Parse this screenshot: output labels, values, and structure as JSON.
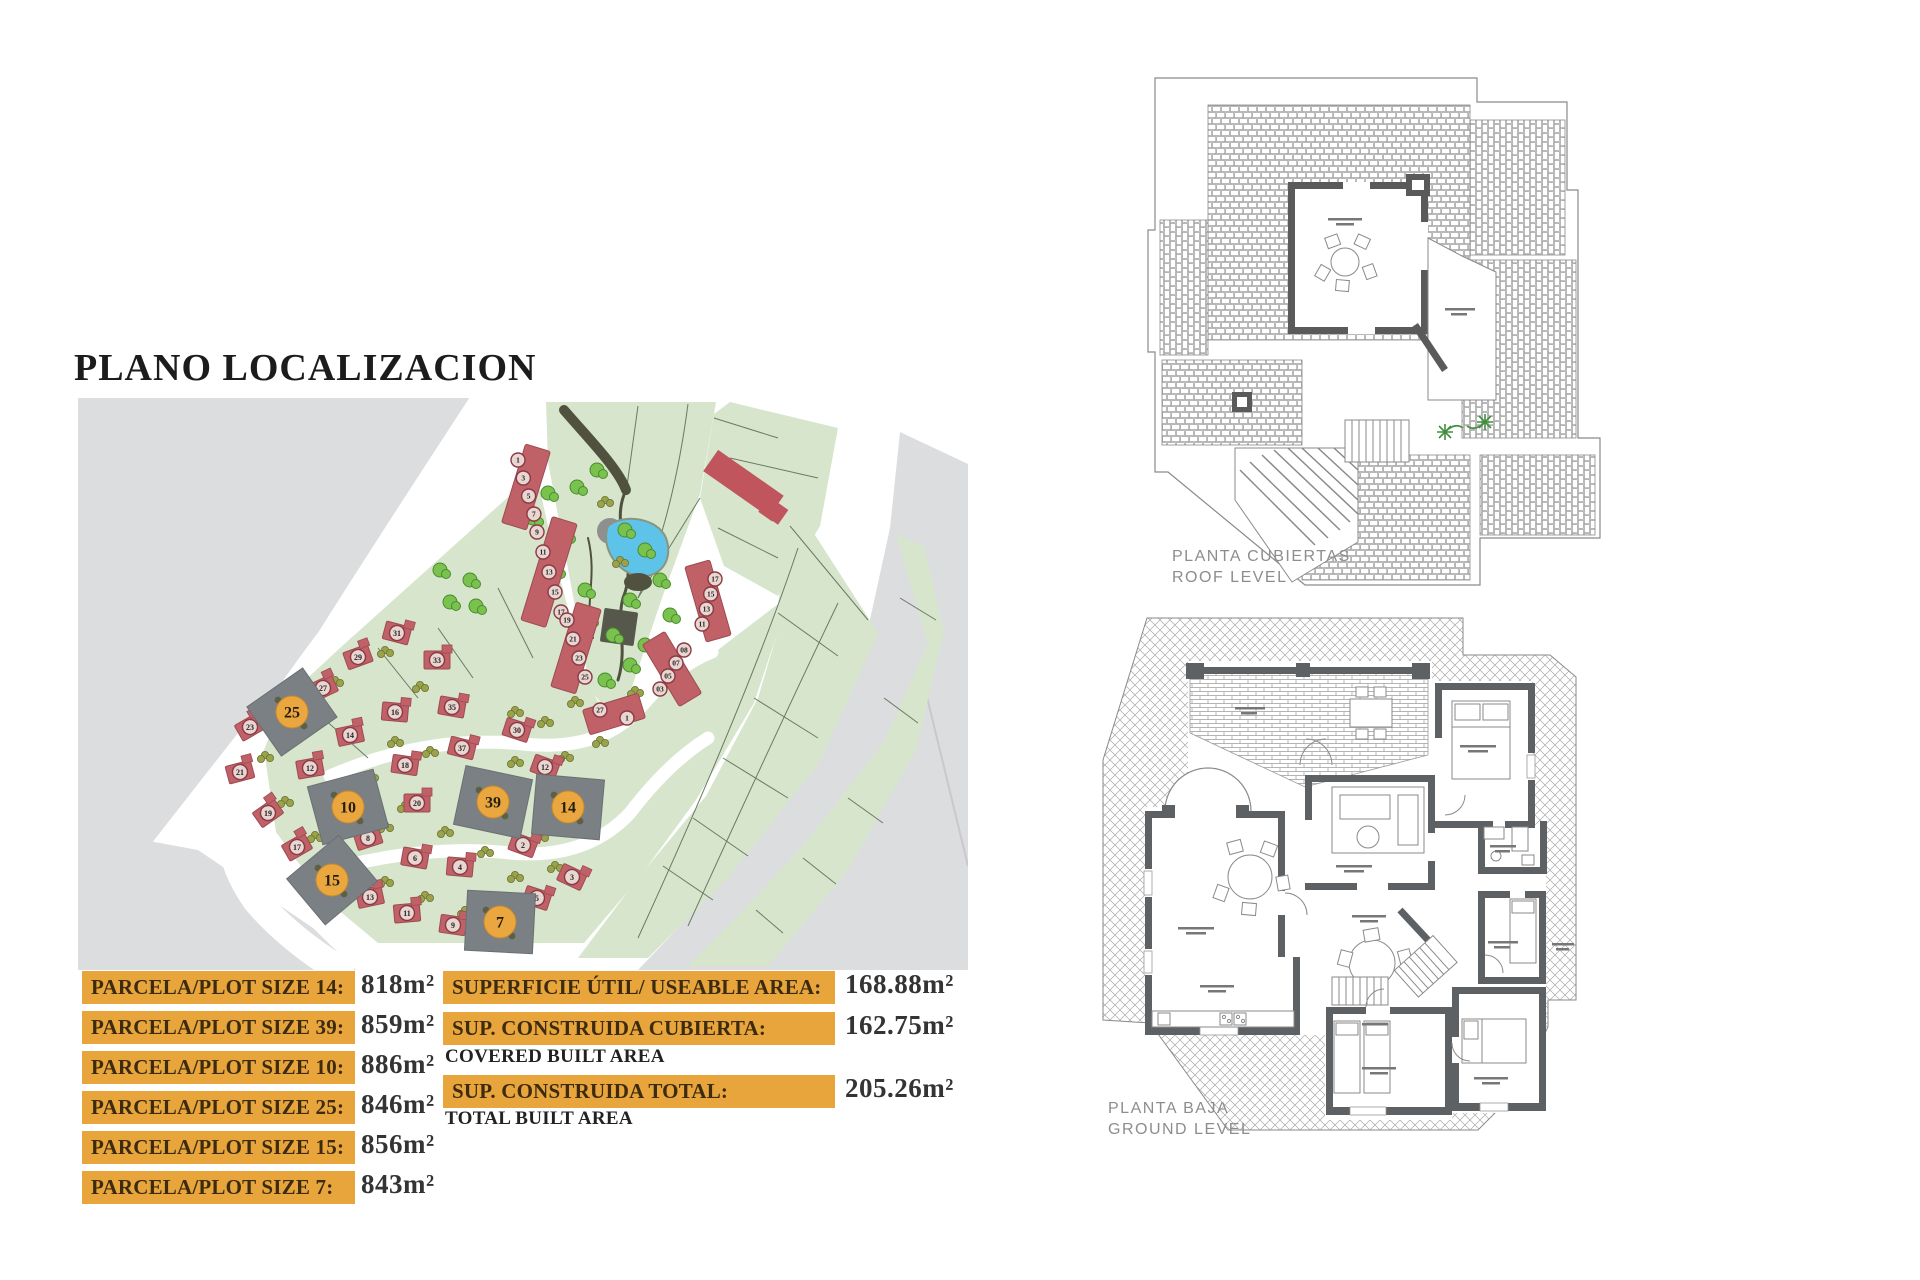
{
  "title": "PLANO LOCALIZACION",
  "tables": {
    "left": {
      "rows": [
        {
          "label": "PARCELA/PLOT SIZE 14:",
          "value": "818m²"
        },
        {
          "label": "PARCELA/PLOT SIZE 39:",
          "value": "859m²"
        },
        {
          "label": "PARCELA/PLOT SIZE 10:",
          "value": "886m²"
        },
        {
          "label": "PARCELA/PLOT SIZE 25:",
          "value": "846m²"
        },
        {
          "label": "PARCELA/PLOT SIZE 15:",
          "value": "856m²"
        },
        {
          "label": "PARCELA/PLOT SIZE 7:",
          "value": "843m²"
        }
      ]
    },
    "right": {
      "rows": [
        {
          "label": "SUPERFICIE ÚTIL/ USEABLE AREA:",
          "value": "168.88m²",
          "sub": ""
        },
        {
          "label": "SUP. CONSTRUIDA CUBIERTA:",
          "value": "162.75m²",
          "sub": "COVERED BUILT AREA"
        },
        {
          "label": "SUP. CONSTRUIDA TOTAL:",
          "value": "205.26m²",
          "sub": "TOTAL BUILT AREA"
        }
      ]
    }
  },
  "plans": {
    "roof": {
      "label_line1": "PLANTA CUBIERTAS",
      "label_line2": "ROOF LEVEL"
    },
    "ground": {
      "label_line1": "PLANTA BAJA",
      "label_line2": "GROUND LEVEL"
    }
  },
  "map": {
    "colors": {
      "green": "#d6e5cc",
      "gray": "#dcddde",
      "plot_gray": "#7b8084",
      "house_red": "#c06067",
      "house_stroke": "#9e4a52",
      "circle_orange": "#eaa73f",
      "tree_green": "#79c24d",
      "tree_olive": "#9aa24b",
      "pond_blue": "#5ec3e8",
      "path_dark": "#50523f",
      "ring_red": "#8a3a42"
    },
    "highlighted_plots": [
      {
        "n": "25",
        "x": 214,
        "y": 314,
        "rot": -35
      },
      {
        "n": "10",
        "x": 270,
        "y": 409,
        "rot": -15
      },
      {
        "n": "39",
        "x": 415,
        "y": 404,
        "rot": 12
      },
      {
        "n": "14",
        "x": 490,
        "y": 409,
        "rot": 5
      },
      {
        "n": "15",
        "x": 254,
        "y": 482,
        "rot": -40
      },
      {
        "n": "7",
        "x": 422,
        "y": 524,
        "rot": 3
      }
    ],
    "houses": [
      [
        "29",
        280,
        259,
        -20
      ],
      [
        "31",
        319,
        235,
        15
      ],
      [
        "33",
        359,
        262,
        0
      ],
      [
        "27",
        245,
        290,
        -25
      ],
      [
        "23",
        172,
        329,
        -30
      ],
      [
        "21",
        162,
        374,
        -15
      ],
      [
        "19",
        190,
        415,
        -35
      ],
      [
        "17",
        219,
        449,
        -30
      ],
      [
        "12",
        232,
        370,
        -10
      ],
      [
        "14",
        272,
        337,
        -12
      ],
      [
        "16",
        317,
        314,
        5
      ],
      [
        "18",
        327,
        367,
        8
      ],
      [
        "20",
        339,
        405,
        0
      ],
      [
        "8",
        290,
        440,
        -18
      ],
      [
        "6",
        337,
        460,
        10
      ],
      [
        "4",
        382,
        469,
        5
      ],
      [
        "2",
        445,
        447,
        20
      ],
      [
        "13",
        292,
        499,
        -12
      ],
      [
        "11",
        329,
        515,
        -5
      ],
      [
        "9",
        375,
        527,
        8
      ],
      [
        "5",
        459,
        500,
        18
      ],
      [
        "3",
        494,
        479,
        25
      ],
      [
        "35",
        374,
        309,
        10
      ],
      [
        "37",
        384,
        350,
        14
      ],
      [
        "30",
        439,
        332,
        18
      ],
      [
        "12",
        467,
        369,
        20
      ]
    ],
    "townhouse_rows": [
      {
        "cx": 448,
        "cy": 89,
        "len": 82,
        "rot": 17,
        "numbers": [
          "1",
          "3",
          "5",
          "7"
        ],
        "sx": 440,
        "sy": 62,
        "dx": 5.3,
        "dy": 18
      },
      {
        "cx": 471,
        "cy": 174,
        "len": 108,
        "rot": 17,
        "numbers": [
          "9",
          "11",
          "13",
          "15",
          "17"
        ],
        "sx": 459,
        "sy": 134,
        "dx": 6,
        "dy": 20
      },
      {
        "cx": 498,
        "cy": 250,
        "len": 88,
        "rot": 17,
        "numbers": [
          "19",
          "21",
          "23",
          "25"
        ],
        "sx": 489,
        "sy": 222,
        "dx": 6,
        "dy": 19
      },
      {
        "cx": 536,
        "cy": 316,
        "len": 58,
        "rot": 73,
        "numbers": [
          "27",
          "1"
        ],
        "sx": 522,
        "sy": 312,
        "dx": 27,
        "dy": 8
      },
      {
        "cx": 630,
        "cy": 203,
        "len": 78,
        "rot": -16,
        "numbers": [
          "17",
          "15",
          "13",
          "11"
        ],
        "sx": 637,
        "sy": 181,
        "dx": -4.3,
        "dy": 15
      },
      {
        "cx": 594,
        "cy": 271,
        "len": 72,
        "rot": -31,
        "numbers": [
          "08",
          "07",
          "05",
          "03"
        ],
        "sx": 606,
        "sy": 252,
        "dx": -8,
        "dy": 13
      }
    ],
    "trees_green": [
      [
        499,
        89
      ],
      [
        519,
        72
      ],
      [
        547,
        132
      ],
      [
        567,
        152
      ],
      [
        582,
        182
      ],
      [
        552,
        202
      ],
      [
        535,
        237
      ],
      [
        567,
        247
      ],
      [
        592,
        217
      ],
      [
        487,
        137
      ],
      [
        477,
        172
      ],
      [
        507,
        192
      ],
      [
        527,
        282
      ],
      [
        552,
        267
      ],
      [
        362,
        172
      ],
      [
        392,
        182
      ],
      [
        372,
        204
      ],
      [
        398,
        208
      ],
      [
        455,
        120
      ],
      [
        470,
        95
      ]
    ],
    "trees_olive": [
      [
        257,
        282
      ],
      [
        307,
        252
      ],
      [
        342,
        287
      ],
      [
        212,
        312
      ],
      [
        187,
        357
      ],
      [
        207,
        402
      ],
      [
        237,
        437
      ],
      [
        269,
        467
      ],
      [
        307,
        482
      ],
      [
        347,
        497
      ],
      [
        387,
        512
      ],
      [
        427,
        517
      ],
      [
        317,
        342
      ],
      [
        352,
        352
      ],
      [
        292,
        377
      ],
      [
        327,
        407
      ],
      [
        367,
        432
      ],
      [
        407,
        452
      ],
      [
        437,
        477
      ],
      [
        477,
        467
      ],
      [
        462,
        437
      ],
      [
        487,
        357
      ],
      [
        437,
        362
      ],
      [
        307,
        427
      ],
      [
        272,
        402
      ],
      [
        437,
        312
      ],
      [
        467,
        322
      ],
      [
        497,
        302
      ],
      [
        522,
        342
      ],
      [
        527,
        102
      ],
      [
        542,
        162
      ],
      [
        512,
        222
      ],
      [
        557,
        292
      ]
    ]
  }
}
